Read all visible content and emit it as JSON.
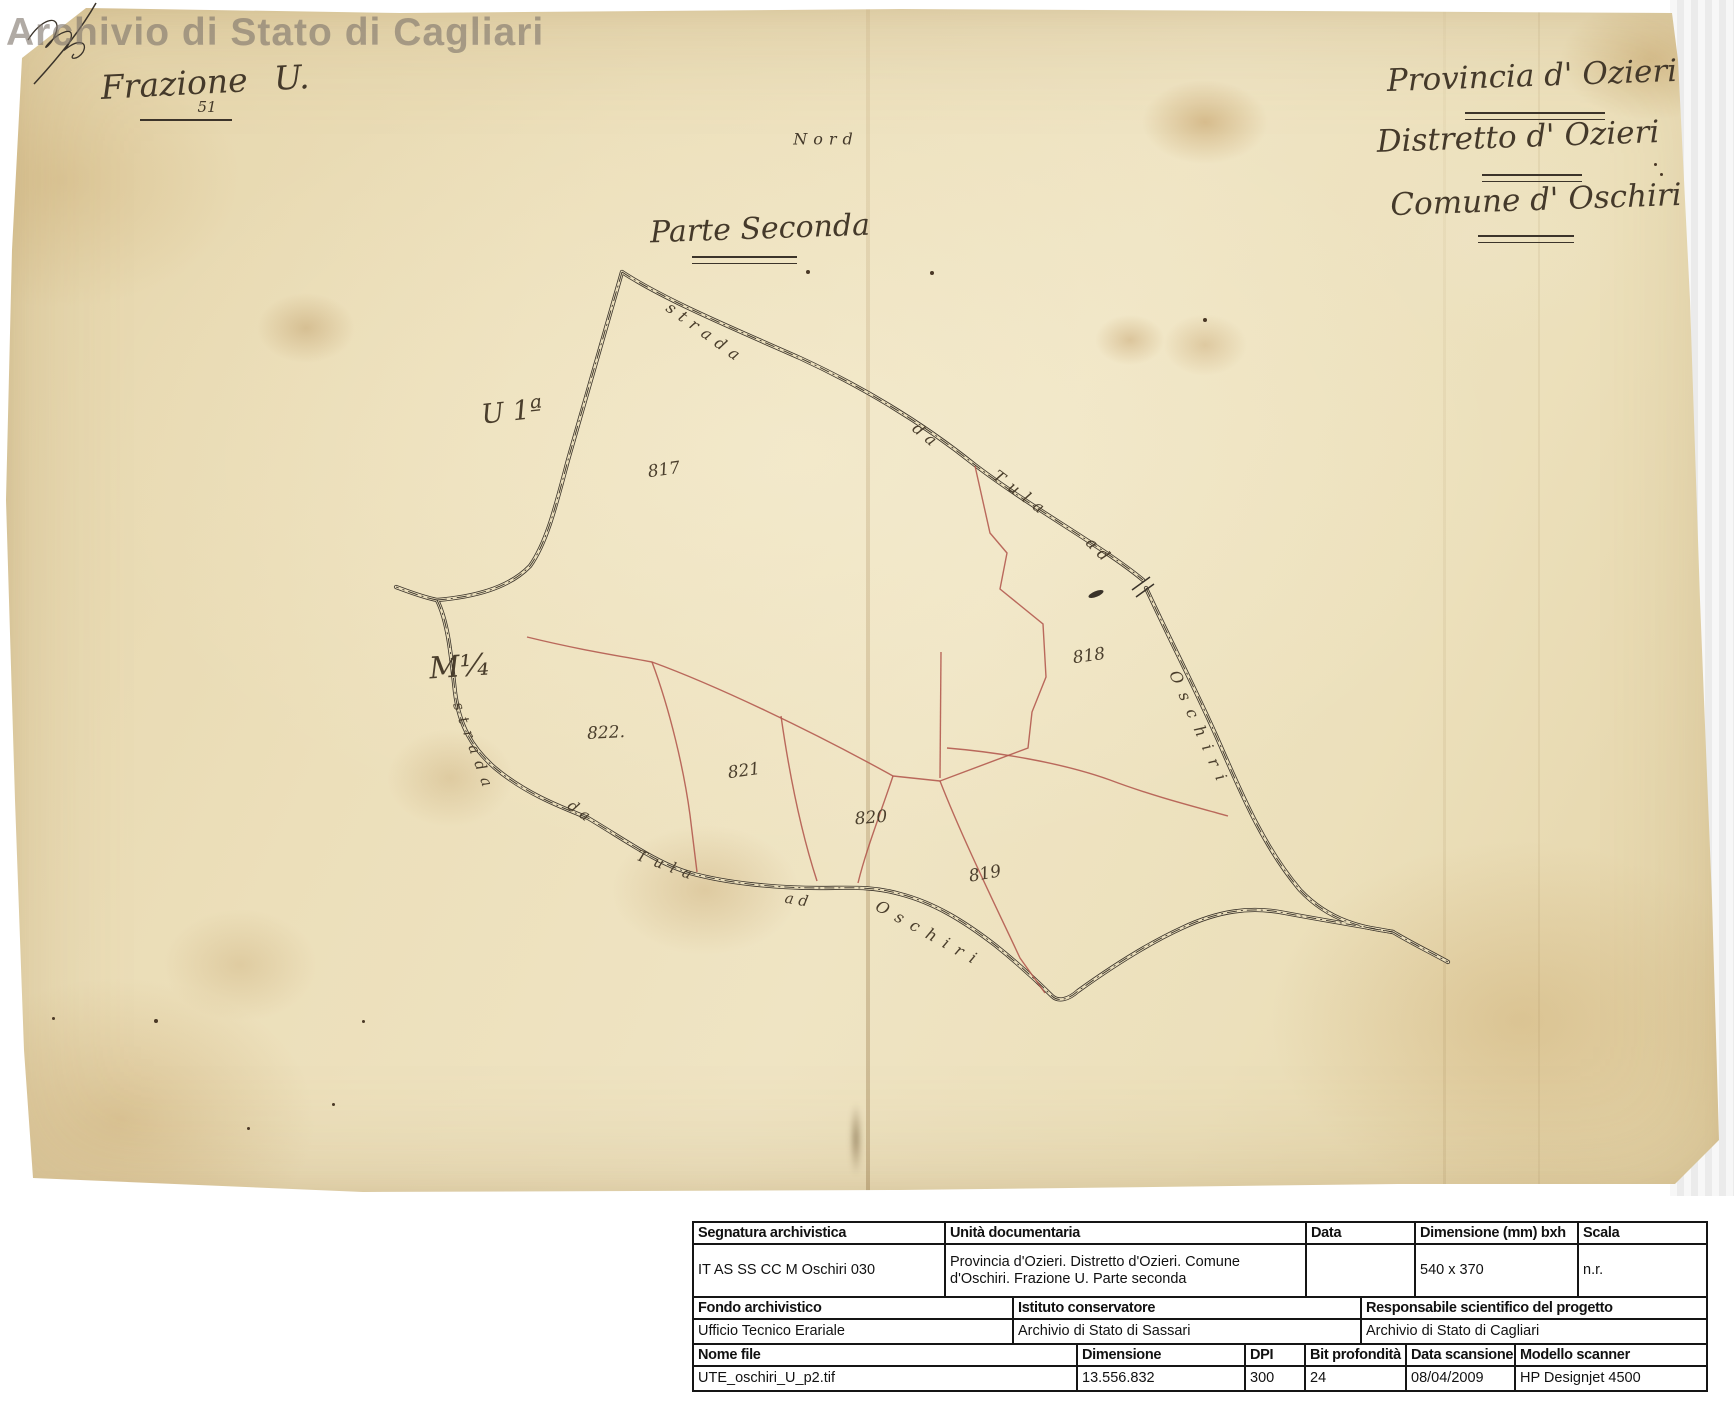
{
  "watermark": "Archivio di Stato di Cagliari",
  "header": {
    "frazione": "Frazione U.",
    "frazione_number": "51",
    "nord": "Nord",
    "parte": "Parte Seconda",
    "provincia": "Provincia d' Ozieri",
    "distretto": "Distretto d' Ozieri",
    "comune": "Comune d' Oschiri"
  },
  "map": {
    "ink_color": "#3a332a",
    "boundary_color": "#b2574c",
    "parcels": [
      {
        "t": "817",
        "x": 664,
        "y": 470,
        "r": -8
      },
      {
        "t": "818",
        "x": 1089,
        "y": 656,
        "r": -8
      },
      {
        "t": "819",
        "x": 985,
        "y": 874,
        "r": -10
      },
      {
        "t": "820",
        "x": 871,
        "y": 818,
        "r": -5
      },
      {
        "t": "821",
        "x": 744,
        "y": 771,
        "r": -8
      },
      {
        "t": "822.",
        "x": 606,
        "y": 733,
        "r": -3
      }
    ],
    "road_labels": [
      {
        "t": "strada",
        "x": 706,
        "y": 333,
        "r": 36,
        "ls": 7,
        "fs": 16
      },
      {
        "t": "da",
        "x": 927,
        "y": 436,
        "r": 40,
        "ls": 6,
        "fs": 16
      },
      {
        "t": "Tula",
        "x": 1022,
        "y": 494,
        "r": 37,
        "ls": 8,
        "fs": 16
      },
      {
        "t": "ad",
        "x": 1100,
        "y": 551,
        "r": 45,
        "ls": 6,
        "fs": 16
      },
      {
        "t": "Oschiri",
        "x": 1200,
        "y": 730,
        "r": 66,
        "ls": 10,
        "fs": 16
      },
      {
        "t": "strada",
        "x": 474,
        "y": 748,
        "r": 70,
        "ls": 8,
        "fs": 15
      },
      {
        "t": "da",
        "x": 581,
        "y": 812,
        "r": 36,
        "ls": 5,
        "fs": 15
      },
      {
        "t": "Tula",
        "x": 668,
        "y": 866,
        "r": 20,
        "ls": 8,
        "fs": 15
      },
      {
        "t": "ad",
        "x": 799,
        "y": 900,
        "r": 10,
        "ls": 5,
        "fs": 15
      },
      {
        "t": "Oschiri",
        "x": 930,
        "y": 934,
        "r": 29,
        "ls": 9,
        "fs": 16
      }
    ],
    "annotations": [
      {
        "t": "U 1ª",
        "x": 512,
        "y": 412,
        "r": -6,
        "fs": 27
      },
      {
        "t": "M¹⁄₄",
        "x": 459,
        "y": 667,
        "r": -4,
        "fs": 30
      }
    ]
  },
  "table": {
    "sections": [
      {
        "headers": [
          "Segnatura archivistica",
          "Unità documentaria",
          "Data",
          "Dimensione (mm) bxh",
          "Scala"
        ],
        "values": [
          "IT AS SS CC M Oschiri 030",
          "Provincia d'Ozieri. Distretto d'Ozieri. Comune d'Oschiri. Frazione U. Parte seconda",
          "",
          "540 x 370",
          "n.r."
        ],
        "widths": [
          250,
          361,
          109,
          163,
          133
        ]
      },
      {
        "headers": [
          "Fondo archivistico",
          "Istituto conservatore",
          "Responsabile scientifico del progetto"
        ],
        "values": [
          "Ufficio Tecnico Erariale",
          "Archivio di Stato di Sassari",
          "Archivio di Stato di Cagliari"
        ],
        "widths": [
          318,
          348,
          350
        ]
      },
      {
        "headers": [
          "Nome file",
          "Dimensione",
          "DPI",
          "Bit profondità",
          "Data scansione",
          "Modello scanner"
        ],
        "values": [
          "UTE_oschiri_U_p2.tif",
          "13.556.832",
          "300",
          "24",
          "08/04/2009",
          "HP Designjet 4500"
        ],
        "widths": [
          382,
          168,
          60,
          101,
          109,
          196
        ]
      }
    ]
  }
}
